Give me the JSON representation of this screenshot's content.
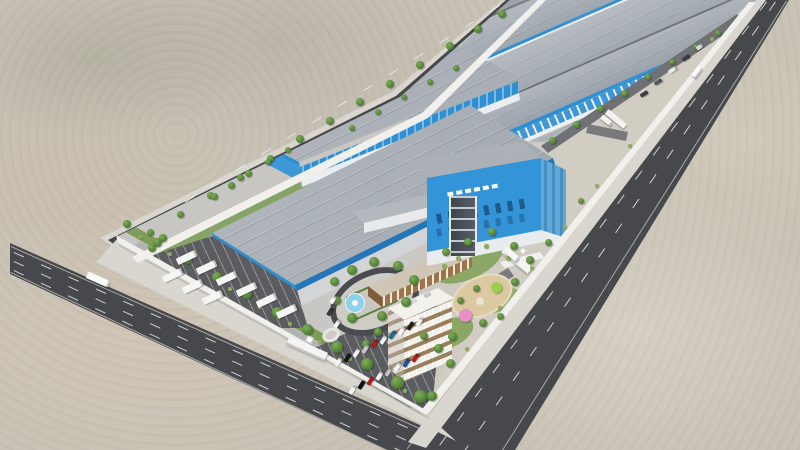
{
  "meta": {
    "description": "Aerial 3D architectural rendering of a long walled industrial park in a desert: rows of gray-roofed, blue-walled warehouses receding to the upper right, a blue headquarters building with an illegible white company logo, an amenity zone with oval fountain plaza, brown canteen, white dormitory block, playground with colored canopies, a truck yard with white trailers, car parking lots, tree-lined perimeter walls and external asphalt roads.",
    "visible_text": ""
  },
  "palette": {
    "sand": "#c8c2b5",
    "sand-light": "#ddd7cb",
    "sand-pink": "#d7c6b4",
    "road": "#47484c",
    "lane-mark": "#e9e9e7",
    "sidewalk": "#d9d6cf",
    "wall": "#f1f0ec",
    "site-ground": "#c7c6c3",
    "apron": "#d1cdc2",
    "inner-road": "#6f7175",
    "lot-asphalt": "#5b5c60",
    "roof-gray": "#a2a8b0",
    "roof-light": "#b9bec4",
    "facade-blue": "#2e8fd3",
    "facade-blue-light": "#5ea8da",
    "window-blue": "#17527f",
    "white-wall": "#e9eef2",
    "grass": "#7d9c57",
    "tree-green": "#4c7a33",
    "bush-green": "#90ab60",
    "canteen-brown": "#9a744c",
    "office-white": "#f2f1ec",
    "office-window": "#826236",
    "fountain-blue": "#8ed1ea",
    "play-tan": "#dcc9a2",
    "play-pink": "#e591c7",
    "play-lime": "#9ccf4e",
    "tower-dark": "#3f444c"
  },
  "objects": {
    "trees": [
      [
        127,
        224,
        8
      ],
      [
        157,
        242,
        9
      ],
      [
        187,
        259,
        9
      ],
      [
        217,
        277,
        10
      ],
      [
        247,
        294,
        10
      ],
      [
        277,
        312,
        11
      ],
      [
        307,
        329,
        11
      ],
      [
        337,
        347,
        12
      ],
      [
        367,
        364,
        12
      ],
      [
        397,
        382,
        13
      ],
      [
        420,
        396,
        13
      ],
      [
        150,
        232,
        7
      ],
      [
        180,
        214,
        7
      ],
      [
        210,
        195,
        7
      ],
      [
        240,
        177,
        7
      ],
      [
        270,
        158,
        7
      ],
      [
        300,
        139,
        8
      ],
      [
        330,
        121,
        8
      ],
      [
        360,
        102,
        8
      ],
      [
        390,
        84,
        8
      ],
      [
        420,
        65,
        8
      ],
      [
        450,
        46,
        8
      ],
      [
        478,
        29,
        8
      ],
      [
        502,
        14,
        8
      ],
      [
        552,
        140,
        7
      ],
      [
        576,
        124,
        7
      ],
      [
        600,
        108,
        7
      ],
      [
        624,
        93,
        7
      ],
      [
        648,
        77,
        6
      ],
      [
        672,
        62,
        6
      ],
      [
        696,
        47,
        6
      ],
      [
        718,
        33,
        6
      ],
      [
        515,
        282,
        8
      ],
      [
        483,
        323,
        8
      ],
      [
        450,
        363,
        9
      ],
      [
        432,
        396,
        10
      ],
      [
        581,
        201,
        6
      ],
      [
        548,
        242,
        7
      ],
      [
        214,
        196,
        7
      ],
      [
        231,
        185,
        7
      ],
      [
        248,
        173,
        7
      ],
      [
        268,
        162,
        6
      ],
      [
        288,
        150,
        6
      ],
      [
        352,
        128,
        6
      ],
      [
        378,
        112,
        6
      ],
      [
        404,
        97,
        6
      ],
      [
        430,
        82,
        6
      ],
      [
        456,
        68,
        6
      ],
      [
        334,
        281,
        9
      ],
      [
        352,
        270,
        10
      ],
      [
        374,
        262,
        10
      ],
      [
        398,
        266,
        10
      ],
      [
        414,
        280,
        10
      ],
      [
        406,
        302,
        10
      ],
      [
        382,
        316,
        10
      ],
      [
        352,
        318,
        10
      ],
      [
        336,
        300,
        9
      ],
      [
        446,
        252,
        8
      ],
      [
        468,
        242,
        8
      ],
      [
        492,
        232,
        8
      ],
      [
        514,
        246,
        8
      ],
      [
        530,
        260,
        8
      ],
      [
        452,
        336,
        9
      ],
      [
        438,
        348,
        9
      ],
      [
        424,
        336,
        8
      ],
      [
        460,
        300,
        7
      ],
      [
        476,
        288,
        7
      ],
      [
        500,
        316,
        7
      ],
      [
        378,
        332,
        8
      ],
      [
        366,
        344,
        8
      ],
      [
        152,
        248,
        8
      ],
      [
        163,
        238,
        8
      ]
    ],
    "bushes": [
      [
        140,
        237,
        4
      ],
      [
        170,
        254,
        4
      ],
      [
        200,
        272,
        4
      ],
      [
        230,
        289,
        4
      ],
      [
        260,
        307,
        4
      ],
      [
        290,
        324,
        4
      ],
      [
        320,
        342,
        4
      ],
      [
        350,
        359,
        4
      ],
      [
        380,
        377,
        4
      ],
      [
        405,
        391,
        4
      ],
      [
        712,
        39,
        4
      ],
      [
        630,
        146,
        4
      ],
      [
        597,
        186,
        4
      ],
      [
        565,
        227,
        4
      ],
      [
        532,
        268,
        4
      ],
      [
        500,
        308,
        4
      ],
      [
        467,
        349,
        4
      ],
      [
        444,
        266,
        5
      ],
      [
        458,
        258,
        5
      ],
      [
        486,
        246,
        5
      ],
      [
        508,
        258,
        5
      ]
    ],
    "vehicles": [
      [
        176,
        254,
        21,
        6.5,
        -25,
        "#f5f5f3"
      ],
      [
        196,
        264,
        21,
        6.5,
        -25,
        "#f5f5f3"
      ],
      [
        216,
        275,
        21,
        6.5,
        -25,
        "#f5f5f3"
      ],
      [
        236,
        286,
        21,
        6.5,
        -25,
        "#f5f5f3"
      ],
      [
        256,
        297,
        21,
        6.5,
        -25,
        "#f5f5f3"
      ],
      [
        276,
        308,
        21,
        6.5,
        -25,
        "#f5f5f3"
      ],
      [
        162,
        272,
        21,
        6.5,
        -25,
        "#f5f5f3"
      ],
      [
        182,
        283,
        21,
        6.5,
        -25,
        "#f5f5f3"
      ],
      [
        202,
        294,
        21,
        6.5,
        -25,
        "#f5f5f3"
      ],
      [
        86,
        276,
        24,
        7,
        24,
        "#fbfbfa"
      ],
      [
        694,
        66,
        6,
        12,
        37,
        "#ffffff"
      ],
      [
        504,
        252,
        16,
        6,
        39,
        "#f8f8f6"
      ],
      [
        600,
        118,
        13,
        5,
        39,
        "#f4f4f2"
      ],
      [
        640,
        92,
        8,
        4,
        -33,
        "#3c3f45"
      ],
      [
        654,
        80,
        8,
        4,
        -33,
        "#565a61"
      ],
      [
        668,
        68,
        9,
        4,
        -33,
        "#e9e9e7"
      ],
      [
        682,
        56,
        8,
        4,
        -33,
        "#393c42"
      ],
      [
        696,
        45,
        7,
        3.5,
        -33,
        "#dadada"
      ],
      [
        334,
        360,
        9,
        4.2,
        -57,
        "#f4f4f2"
      ],
      [
        343,
        356,
        9,
        4.2,
        -57,
        "#17181a"
      ],
      [
        352,
        351,
        9,
        4.2,
        -57,
        "#f4f4f2"
      ],
      [
        361,
        347,
        9,
        4.2,
        -57,
        "#c6c6c4"
      ],
      [
        370,
        342,
        9,
        4.2,
        -57,
        "#a8201e"
      ],
      [
        379,
        338,
        9,
        4.2,
        -57,
        "#f4f4f2"
      ],
      [
        388,
        333,
        9,
        4.2,
        -57,
        "#1b6f8e"
      ],
      [
        397,
        329,
        9,
        4.2,
        -57,
        "#f4f4f2"
      ],
      [
        406,
        324,
        9,
        4.2,
        -57,
        "#222222"
      ],
      [
        415,
        320,
        9,
        4.2,
        -57,
        "#f4f4f2"
      ],
      [
        348,
        388,
        9,
        4.2,
        -57,
        "#f4f4f2"
      ],
      [
        357,
        383,
        9,
        4.2,
        -57,
        "#0f0f12"
      ],
      [
        366,
        379,
        9,
        4.2,
        -57,
        "#a8201e"
      ],
      [
        375,
        374,
        9,
        4.2,
        -57,
        "#f4f4f2"
      ],
      [
        384,
        370,
        9,
        4.2,
        -57,
        "#c0c0be"
      ],
      [
        393,
        365,
        9,
        4.2,
        -57,
        "#f4f4f2"
      ],
      [
        402,
        361,
        9,
        4.2,
        -57,
        "#1e4f9a"
      ],
      [
        411,
        356,
        9,
        4.2,
        -57,
        "#a8201e"
      ],
      [
        329,
        298,
        8,
        4,
        -57,
        "#f4f4f2"
      ],
      [
        326,
        310,
        8,
        4,
        -57,
        "#3a3a3a"
      ],
      [
        333,
        322,
        8,
        4,
        -57,
        "#f4f4f2"
      ]
    ]
  }
}
